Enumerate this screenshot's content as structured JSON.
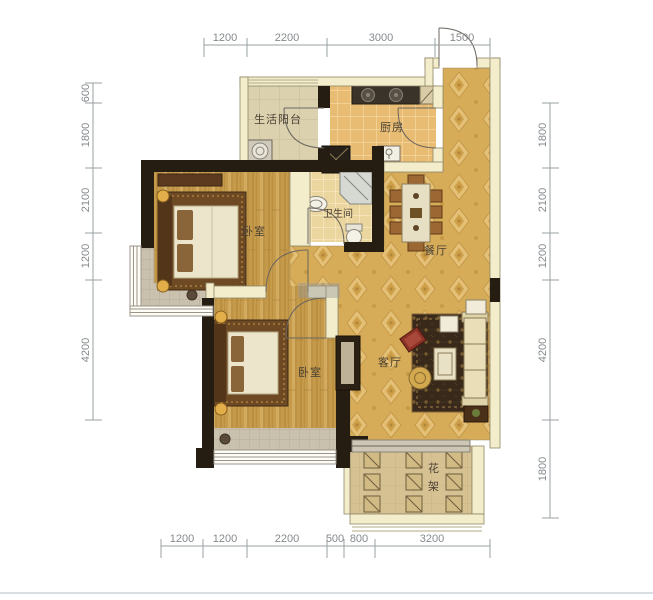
{
  "plan": {
    "rooms": {
      "laundry_balcony": "生活阳台",
      "kitchen": "厨房",
      "bedroom_top": "卧室",
      "bathroom": "卫生间",
      "dining": "餐厅",
      "bedroom_bottom": "卧室",
      "living": "客厅",
      "flower_rack_char1": "花",
      "flower_rack_char2": "架"
    },
    "dimensions": {
      "top": [
        "1200",
        "2200",
        "3000",
        "1500"
      ],
      "bottom": [
        "1200",
        "1200",
        "2200",
        "500",
        "800",
        "3200"
      ],
      "left": [
        "600",
        "1800",
        "2100",
        "1200",
        "4200"
      ],
      "right": [
        "1800",
        "2100",
        "1200",
        "4200",
        "1800"
      ]
    },
    "colors": {
      "wall_light": "#f3edcb",
      "wall_dark": "#251c12",
      "wood_floor": "#c59a4b",
      "damask_floor": "#d7ac59",
      "kitchen_tile": "#e8bc72",
      "bath_tile": "#ecd69f",
      "balcony_tile": "#dbd1ae",
      "rug": "#38291b",
      "dimension_line": "#9aa0a3"
    }
  }
}
